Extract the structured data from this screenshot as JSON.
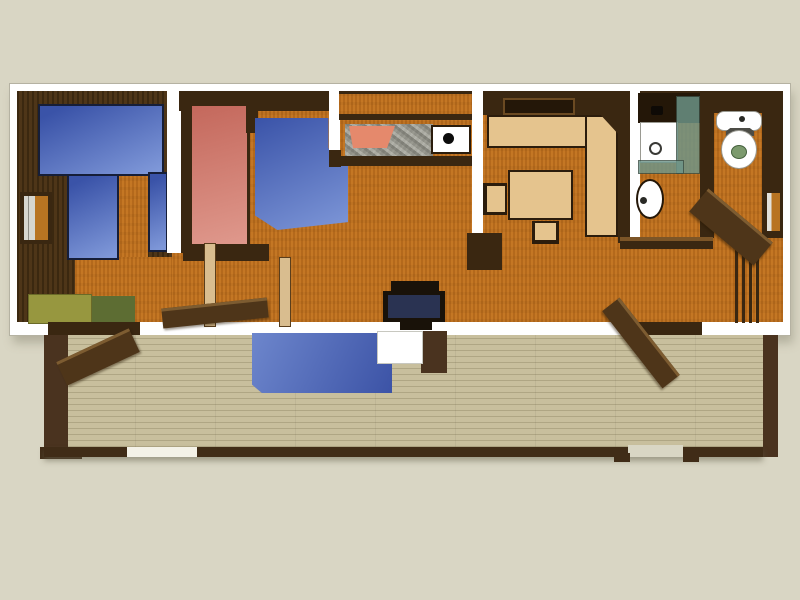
{
  "scene": {
    "type": "3d-rendered floor plan, top-down view",
    "description": "Single-wide cabin / mobile-home floor plan with front deck",
    "areas": [
      "bedroom-left",
      "bedroom-middle",
      "kitchen",
      "living-area",
      "dining-nook",
      "bathroom",
      "toilet-room",
      "entry-steps",
      "deck"
    ],
    "furniture": [
      "double-bed-blue",
      "single-bed-blue",
      "single-bed-red",
      "corner-sofa-blue",
      "kitchen-counter",
      "cooktop",
      "kitchen-sink",
      "dining-window",
      "corner-bench",
      "dining-table",
      "chairs",
      "tv",
      "shower-stall",
      "vanity-sink",
      "toilet",
      "open-doors",
      "deck-mat-blue",
      "deck-table"
    ]
  },
  "colors": {
    "bg": "#d9d6c4",
    "frame_white": "#ffffff",
    "wall_dark": "#3a2711",
    "wall_dark2": "#241708",
    "wood": "#c0711e",
    "wood_dark_floor": "#452e13",
    "blue_a": "#3a53a8",
    "blue_b": "#7e97d8",
    "deck_blue_a": "#6d86cc",
    "deck_blue_b": "#3c53a6",
    "red_a": "#c4685c",
    "red_b": "#e09a8e",
    "olive": "#97973f",
    "olive_dark": "#5d6d33",
    "tan": "#e5c48e",
    "tan_leaf": "#d9bd8f",
    "granite": "#a6a69e",
    "salmon": "#e5896c",
    "glass_teal": "#6e968a",
    "deck_floor": "#c8bf9d",
    "deck_frame": "#4a331f",
    "rail": "#402c17",
    "door_face": "#4e3519",
    "door_edge": "#7d5c31",
    "tv_frame": "#191209",
    "tv_screen": "#2a3352",
    "toilet_green": "#7c9a6e"
  }
}
